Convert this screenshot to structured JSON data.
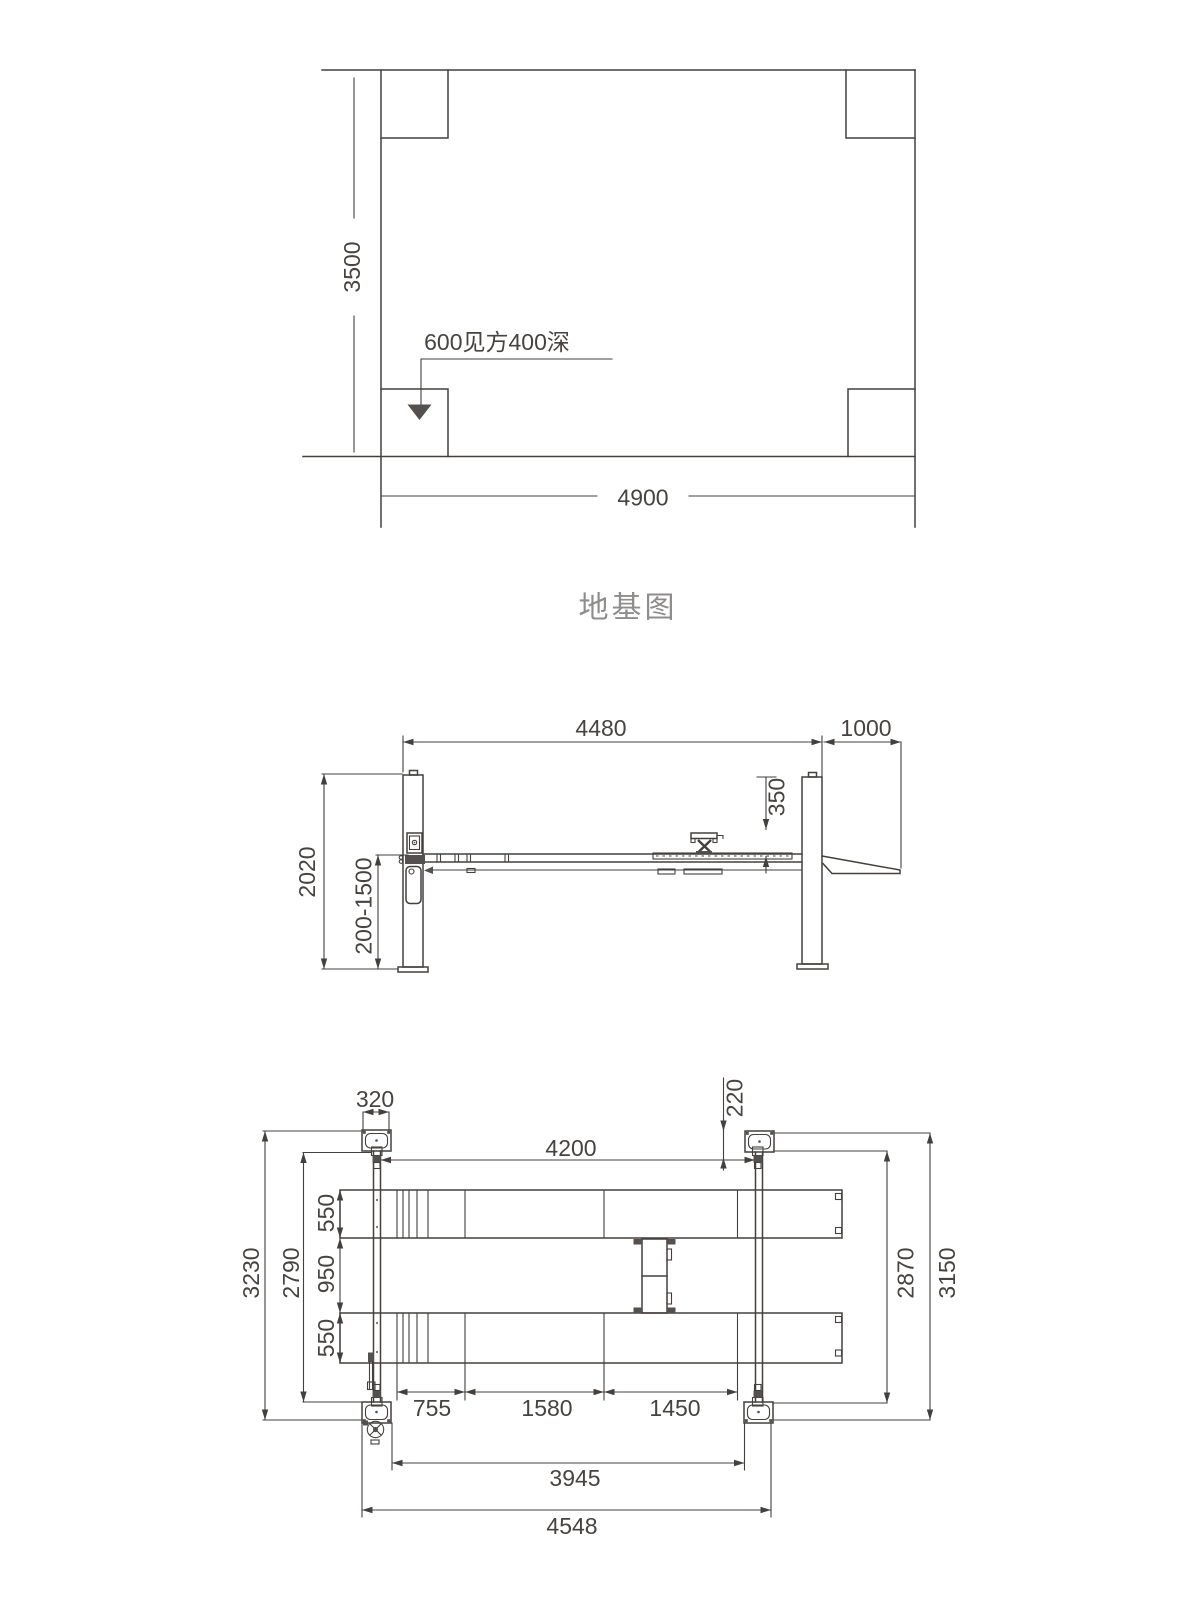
{
  "title": "地基图",
  "foundation": {
    "width": "4900",
    "height": "3500",
    "pit_note": "600见方400深"
  },
  "elevation": {
    "overall_span": "4480",
    "ramp_length": "1000",
    "jack_pad_height": "350",
    "post_height": "2020",
    "lift_range": "200-1500"
  },
  "plan": {
    "post_width": "320",
    "beam_offset": "220",
    "inner_span": "4200",
    "runway_width_front": "550",
    "runway_gap": "950",
    "runway_width_rear": "550",
    "outer_width_left": "3230",
    "inner_width_left": "2790",
    "inner_width_right": "2870",
    "outer_width_right": "3150",
    "segment_a": "755",
    "segment_b": "1580",
    "segment_c": "1450",
    "inner_length": "3945",
    "outer_length": "4548"
  }
}
